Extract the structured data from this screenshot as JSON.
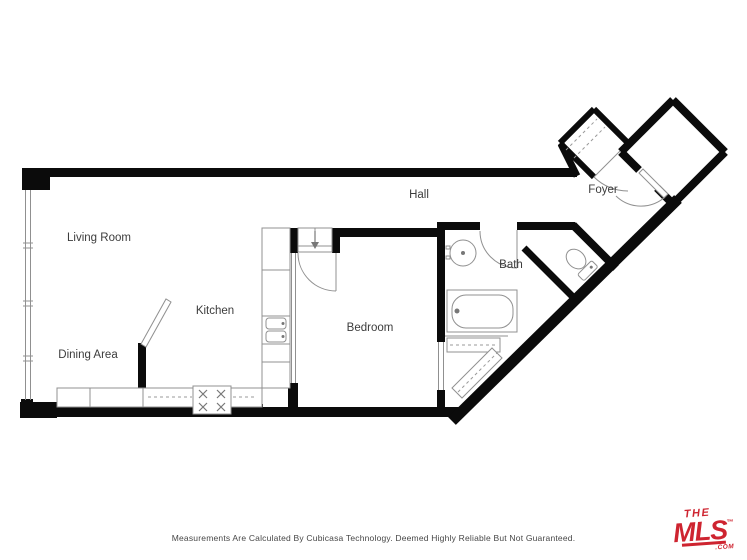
{
  "colors": {
    "wall": "#0b0b0b",
    "line": "#909090",
    "dash": "#9a9a9a",
    "label": "#3c3c3c",
    "logoRed": "#ce2430",
    "bg": "#ffffff"
  },
  "rooms": {
    "living_room": "Living Room",
    "dining_area": "Dining Area",
    "kitchen": "Kitchen",
    "bedroom": "Bedroom",
    "hall": "Hall",
    "bath": "Bath",
    "foyer": "Foyer"
  },
  "footer": {
    "disclaimer": "Measurements Are Calculated By Cubicasa Technology. Deemed Highly Reliable But Not Guaranteed."
  },
  "logo": {
    "the": "THE",
    "mls": "MLS",
    "tm": "™",
    "com": ".COM"
  }
}
